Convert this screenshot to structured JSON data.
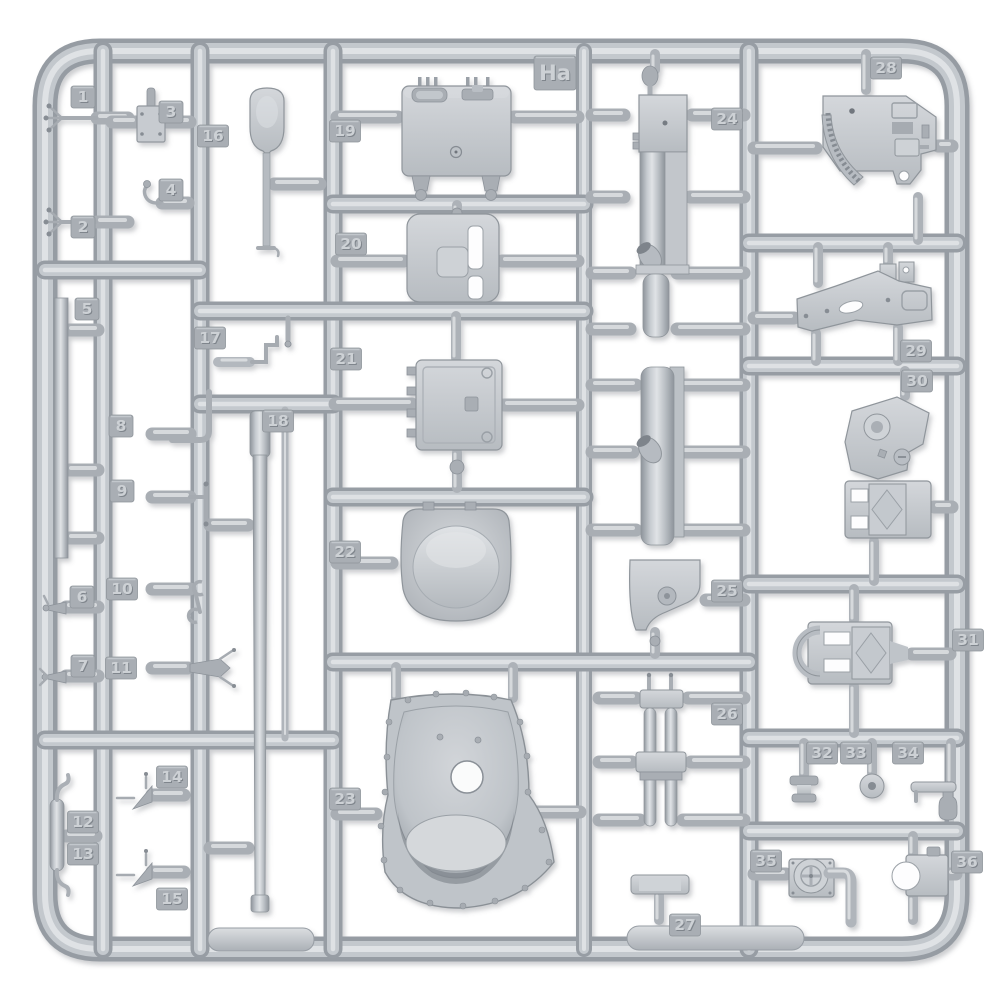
{
  "sprue": {
    "letter": "Ha",
    "description_note": "injection-molded model kit sprue, light gray plastic, numbered part tags",
    "colors": {
      "background": "#ffffff",
      "plastic": "#c6cad0",
      "plastic_shadow": "#8f959b",
      "plastic_highlight": "#e2e5e8",
      "tag_fill": "#a9aeb4",
      "tag_text_light": "#cdd1d5",
      "tag_text_shadow": "#7f858c"
    },
    "tags": [
      {
        "label": "Ha",
        "x": 555,
        "y": 73
      },
      {
        "label": "1",
        "x": 83,
        "y": 97
      },
      {
        "label": "2",
        "x": 83,
        "y": 227
      },
      {
        "label": "3",
        "x": 171,
        "y": 112
      },
      {
        "label": "4",
        "x": 171,
        "y": 190
      },
      {
        "label": "5",
        "x": 87,
        "y": 309
      },
      {
        "label": "6",
        "x": 82,
        "y": 597
      },
      {
        "label": "7",
        "x": 83,
        "y": 666
      },
      {
        "label": "8",
        "x": 121,
        "y": 426
      },
      {
        "label": "9",
        "x": 122,
        "y": 491
      },
      {
        "label": "10",
        "x": 122,
        "y": 589
      },
      {
        "label": "11",
        "x": 121,
        "y": 668
      },
      {
        "label": "12",
        "x": 83,
        "y": 822
      },
      {
        "label": "13",
        "x": 83,
        "y": 854
      },
      {
        "label": "14",
        "x": 172,
        "y": 777
      },
      {
        "label": "15",
        "x": 172,
        "y": 899
      },
      {
        "label": "16",
        "x": 213,
        "y": 136
      },
      {
        "label": "17",
        "x": 210,
        "y": 338
      },
      {
        "label": "18",
        "x": 278,
        "y": 421
      },
      {
        "label": "19",
        "x": 345,
        "y": 131
      },
      {
        "label": "20",
        "x": 351,
        "y": 244
      },
      {
        "label": "21",
        "x": 346,
        "y": 359
      },
      {
        "label": "22",
        "x": 345,
        "y": 552
      },
      {
        "label": "23",
        "x": 345,
        "y": 799
      },
      {
        "label": "24",
        "x": 727,
        "y": 119
      },
      {
        "label": "25",
        "x": 727,
        "y": 591
      },
      {
        "label": "26",
        "x": 727,
        "y": 714
      },
      {
        "label": "27",
        "x": 685,
        "y": 925
      },
      {
        "label": "28",
        "x": 886,
        "y": 68
      },
      {
        "label": "29",
        "x": 916,
        "y": 351
      },
      {
        "label": "30",
        "x": 917,
        "y": 381
      },
      {
        "label": "31",
        "x": 968,
        "y": 640
      },
      {
        "label": "32",
        "x": 822,
        "y": 753
      },
      {
        "label": "33",
        "x": 856,
        "y": 753
      },
      {
        "label": "34",
        "x": 908,
        "y": 753
      },
      {
        "label": "35",
        "x": 766,
        "y": 861
      },
      {
        "label": "36",
        "x": 967,
        "y": 862
      }
    ]
  }
}
